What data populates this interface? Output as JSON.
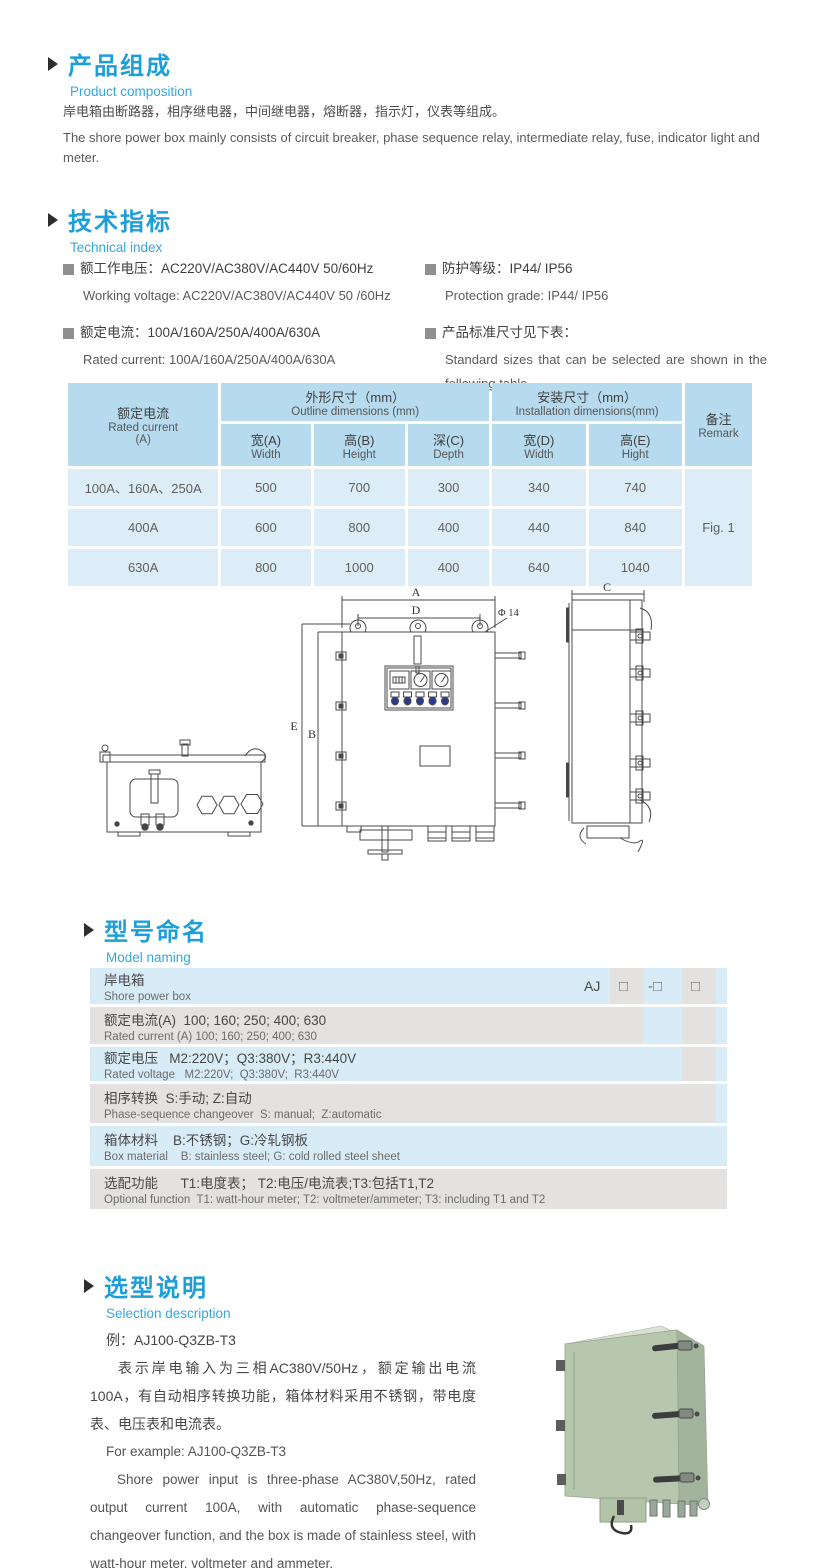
{
  "colors": {
    "page_background": "#ffffff",
    "accent_title": "#1e9ed9",
    "accent_subtitle": "#35a7dc",
    "table_header_bg": "#b7dbee",
    "table_body_bg": "#dcedf8",
    "model_row_gray": "#e3e2e0",
    "model_row_blue": "#d8ecf8",
    "indicator_blue": "#2a3a8c",
    "cabinet_green": "#b6c7ae"
  },
  "sections": {
    "composition": {
      "title_zh": "产品组成",
      "title_en": "Product  composition",
      "body_zh": "岸电箱由断路器，相序继电器，中间继电器，熔断器，指示灯，仪表等组成。",
      "body_en": "The shore power box mainly consists of circuit breaker, phase sequence relay, intermediate relay, fuse, indicator light and meter."
    },
    "technical": {
      "title_zh": "技术指标",
      "title_en": "Technical index",
      "specs": [
        {
          "zh": "额工作电压：AC220V/AC380V/AC440V  50/60Hz",
          "en": "Working voltage: AC220V/AC380V/AC440V 50 /60Hz"
        },
        {
          "zh": "额定电流：100A/160A/250A/400A/630A",
          "en": "Rated current: 100A/160A/250A/400A/630A"
        },
        {
          "zh": "防护等级：IP44/ IP56",
          "en": "Protection grade: IP44/ IP56"
        },
        {
          "zh": "产品标准尺寸见下表：",
          "en": "Standard sizes that can be selected are shown in the following table"
        }
      ]
    },
    "model": {
      "title_zh": "型号命名",
      "title_en": "Model naming"
    },
    "selection": {
      "title_zh": "选型说明",
      "title_en": "Selection description",
      "example_zh": "例：AJ100-Q3ZB-T3",
      "para_zh": "表示岸电输入为三相AC380V/50Hz，额定输出电流100A，有自动相序转换功能，箱体材料采用不锈钢，带电度表、电压表和电流表。",
      "example_en": "For example: AJ100-Q3ZB-T3",
      "para_en": "Shore power input is three-phase AC380V,50Hz, rated output current 100A, with automatic phase-sequence changeover function, and the box is made of stainless steel, with watt-hour meter, voltmeter and ammeter."
    }
  },
  "dim_table": {
    "header": {
      "rated_current_zh": "额定电流",
      "rated_current_en": "Rated current",
      "rated_current_unit": "(A)",
      "outline_zh": "外形尺寸（mm）",
      "outline_en": "Outline dimensions (mm)",
      "install_zh": "安装尺寸（mm）",
      "install_en": "Installation dimensions(mm)",
      "remark_zh": "备注",
      "remark_en": "Remark",
      "sub": [
        {
          "zh": "宽(A)",
          "en": "Width"
        },
        {
          "zh": "高(B)",
          "en": "Height"
        },
        {
          "zh": "深(C)",
          "en": "Depth"
        },
        {
          "zh": "宽(D)",
          "en": "Width"
        },
        {
          "zh": "高(E)",
          "en": "Hight"
        }
      ]
    },
    "rows": [
      {
        "current": "100A、160A、250A",
        "w": "500",
        "h": "700",
        "d": "300",
        "iw": "340",
        "ih": "740"
      },
      {
        "current": "400A",
        "w": "600",
        "h": "800",
        "d": "400",
        "iw": "440",
        "ih": "840"
      },
      {
        "current": "630A",
        "w": "800",
        "h": "1000",
        "d": "400",
        "iw": "640",
        "ih": "1040"
      }
    ],
    "remark": "Fig. 1"
  },
  "drawing": {
    "labels": {
      "a": "A",
      "d": "D",
      "phi": "Φ 14",
      "b": "B",
      "e": "E",
      "c": "C"
    }
  },
  "model_naming": {
    "prefix": "AJ",
    "codes": [
      "□",
      "-□",
      "□"
    ],
    "rows": [
      {
        "zh": "岸电箱",
        "en": "Shore power box"
      },
      {
        "zh": "额定电流(A)  100; 160; 250; 400; 630",
        "en": "Rated current (A) 100; 160; 250; 400; 630"
      },
      {
        "zh": "额定电压   M2:220V；Q3:380V；R3:440V",
        "en": "Rated voltage   M2:220V;  Q3:380V;  R3:440V"
      },
      {
        "zh": "相序转换  S:手动; Z:自动",
        "en": "Phase-sequence changeover  S: manual;  Z:automatic"
      },
      {
        "zh": "箱体材料    B:不锈钢；G:冷轧钢板",
        "en": "Box material    B: stainless steel; G: cold rolled steel sheet"
      },
      {
        "zh": "选配功能      T1:电度表； T2:电压/电流表;T3:包括T1,T2",
        "en": "Optional function  T1: watt-hour meter; T2: voltmeter/ammeter; T3: including T1 and T2"
      }
    ]
  }
}
